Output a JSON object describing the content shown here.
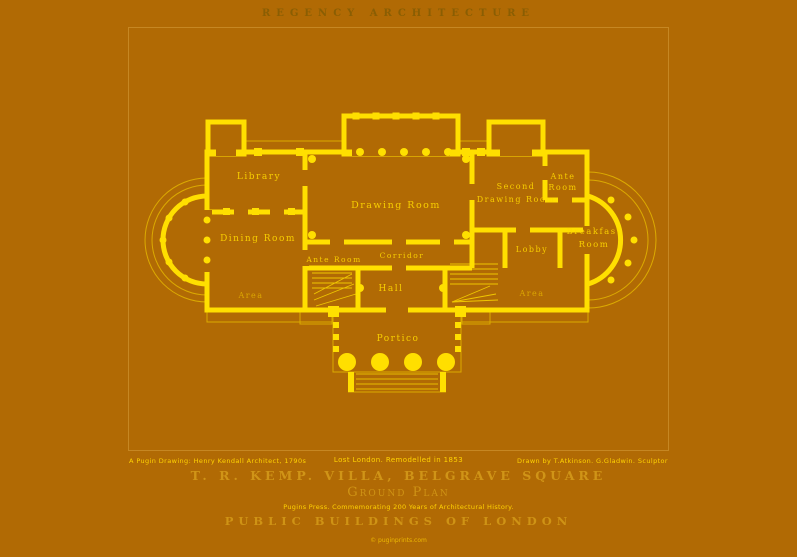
{
  "poster": {
    "header_title": "REGENCY ARCHITECTURE",
    "credits": {
      "left": "A Pugin Drawing: Henry Kendall Architect, 1790s",
      "center": "Lost London. Remodelled in 1853",
      "right": "Drawn by T.Atkinson. G.Gladwin. Sculptor"
    },
    "title": "T. R. KEMP. VILLA, BELGRAVE SQUARE",
    "plan_label": "Ground Plan",
    "series_note": "Pugins Press. Commemorating 200 Years of Architectural History.",
    "series_title": "PUBLIC BUILDINGS OF LONDON",
    "copyright": "© puginprints.com",
    "colors": {
      "background": "#b16a04",
      "plan_yellow": "#ffdf00",
      "gold": "#d09417",
      "caption_yellow": "#ffd303",
      "header_bronze": "#8a5e03"
    },
    "plan": {
      "rooms": {
        "library": "Library",
        "dining_room": "Dining Room",
        "drawing_room": "Drawing Room",
        "second_drawing_line1": "Second",
        "second_drawing_line2": "Drawing Room",
        "ante_right_line1": "Ante",
        "ante_right_line2": "Room",
        "breakfast_line1": "Breakfast",
        "breakfast_line2": "Room",
        "lobby": "Lobby",
        "ante_center": "Ante Room",
        "corridor": "Corridor",
        "hall": "Hall",
        "area_left": "Area",
        "area_right": "Area",
        "portico": "Portico"
      }
    }
  }
}
